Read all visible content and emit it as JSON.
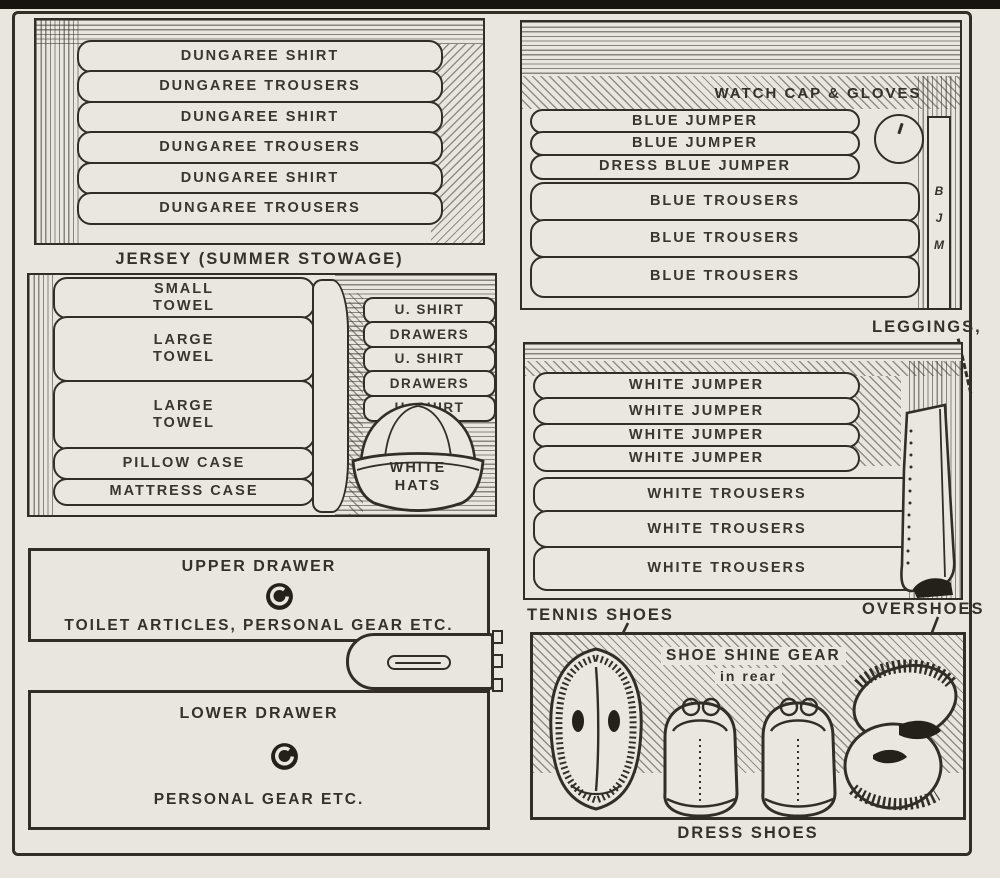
{
  "colors": {
    "paper": "#e9e6df",
    "ink": "#322e27"
  },
  "dungarees_panel": {
    "items": [
      "DUNGAREE SHIRT",
      "DUNGAREE TROUSERS",
      "DUNGAREE SHIRT",
      "DUNGAREE TROUSERS",
      "DUNGAREE SHIRT",
      "DUNGAREE TROUSERS"
    ],
    "caption": "JERSEY (SUMMER STOWAGE)"
  },
  "linens_panel": {
    "left_stack": [
      "SMALL\nTOWEL",
      "LARGE\nTOWEL",
      "LARGE\nTOWEL",
      "PILLOW CASE",
      "MATTRESS CASE"
    ],
    "right_stack": [
      "U. SHIRT",
      "DRAWERS",
      "U. SHIRT",
      "DRAWERS",
      "U. SHIRT"
    ],
    "hat_label": "WHITE\nHATS"
  },
  "drawers_panel": {
    "upper_title": "UPPER DRAWER",
    "upper_contents": "TOILET ARTICLES, PERSONAL GEAR ETC.",
    "lower_title": "LOWER DRAWER",
    "lower_contents": "PERSONAL GEAR ETC."
  },
  "blues_panel": {
    "shelf_label": "WATCH CAP & GLOVES",
    "items": [
      "BLUE JUMPER",
      "BLUE JUMPER",
      "DRESS BLUE JUMPER",
      "BLUE TROUSERS",
      "BLUE TROUSERS",
      "BLUE TROUSERS"
    ],
    "roll_letters": [
      "B",
      "J",
      "M"
    ],
    "below_label": "LEGGINGS,"
  },
  "whites_panel": {
    "items": [
      "WHITE JUMPER",
      "WHITE JUMPER",
      "WHITE JUMPER",
      "WHITE JUMPER",
      "WHITE TROUSERS",
      "WHITE TROUSERS",
      "WHITE TROUSERS"
    ],
    "tennis_label": "TENNIS SHOES",
    "overshoes_label": "OVERSHOES"
  },
  "shoes_panel": {
    "inner_label": "SHOE SHINE GEAR",
    "inner_sublabel": "in rear",
    "caption": "DRESS SHOES"
  }
}
